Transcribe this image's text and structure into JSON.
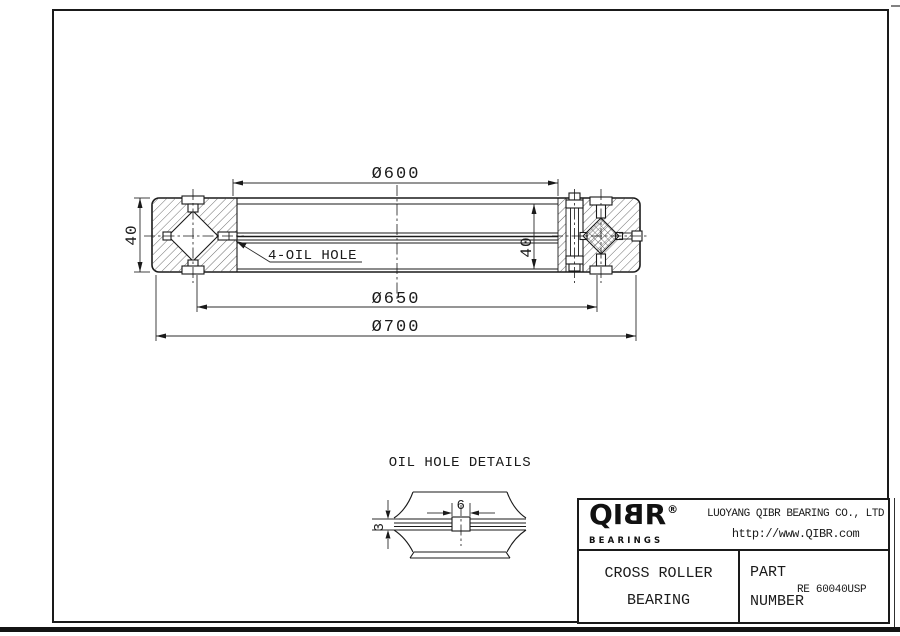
{
  "drawing": {
    "main_view": {
      "dims": {
        "bore_diameter": "Ø600",
        "mount_circle": "Ø650",
        "outer_diameter": "Ø700",
        "height_left": "40",
        "height_right": "40"
      },
      "oil_hole_callout": "4-OIL HOLE"
    },
    "detail_view": {
      "title": "OIL HOLE DETAILS",
      "hole_width": "6",
      "hole_depth": "3"
    }
  },
  "title_block": {
    "logo": {
      "part1": "QI",
      "part2": "B",
      "part3": "R",
      "reg": "®",
      "tagline": "BEARINGS"
    },
    "company_name": "LUOYANG QIBR BEARING CO., LTD",
    "website": "http://www.QIBR.com",
    "product_name_line1": "CROSS ROLLER",
    "product_name_line2": "BEARING",
    "part_label_line1": "PART",
    "part_label_line2": "NUMBER",
    "part_number": "RE 60040USP"
  },
  "colors": {
    "line": "#1a1a1a",
    "background": "#ffffff"
  }
}
